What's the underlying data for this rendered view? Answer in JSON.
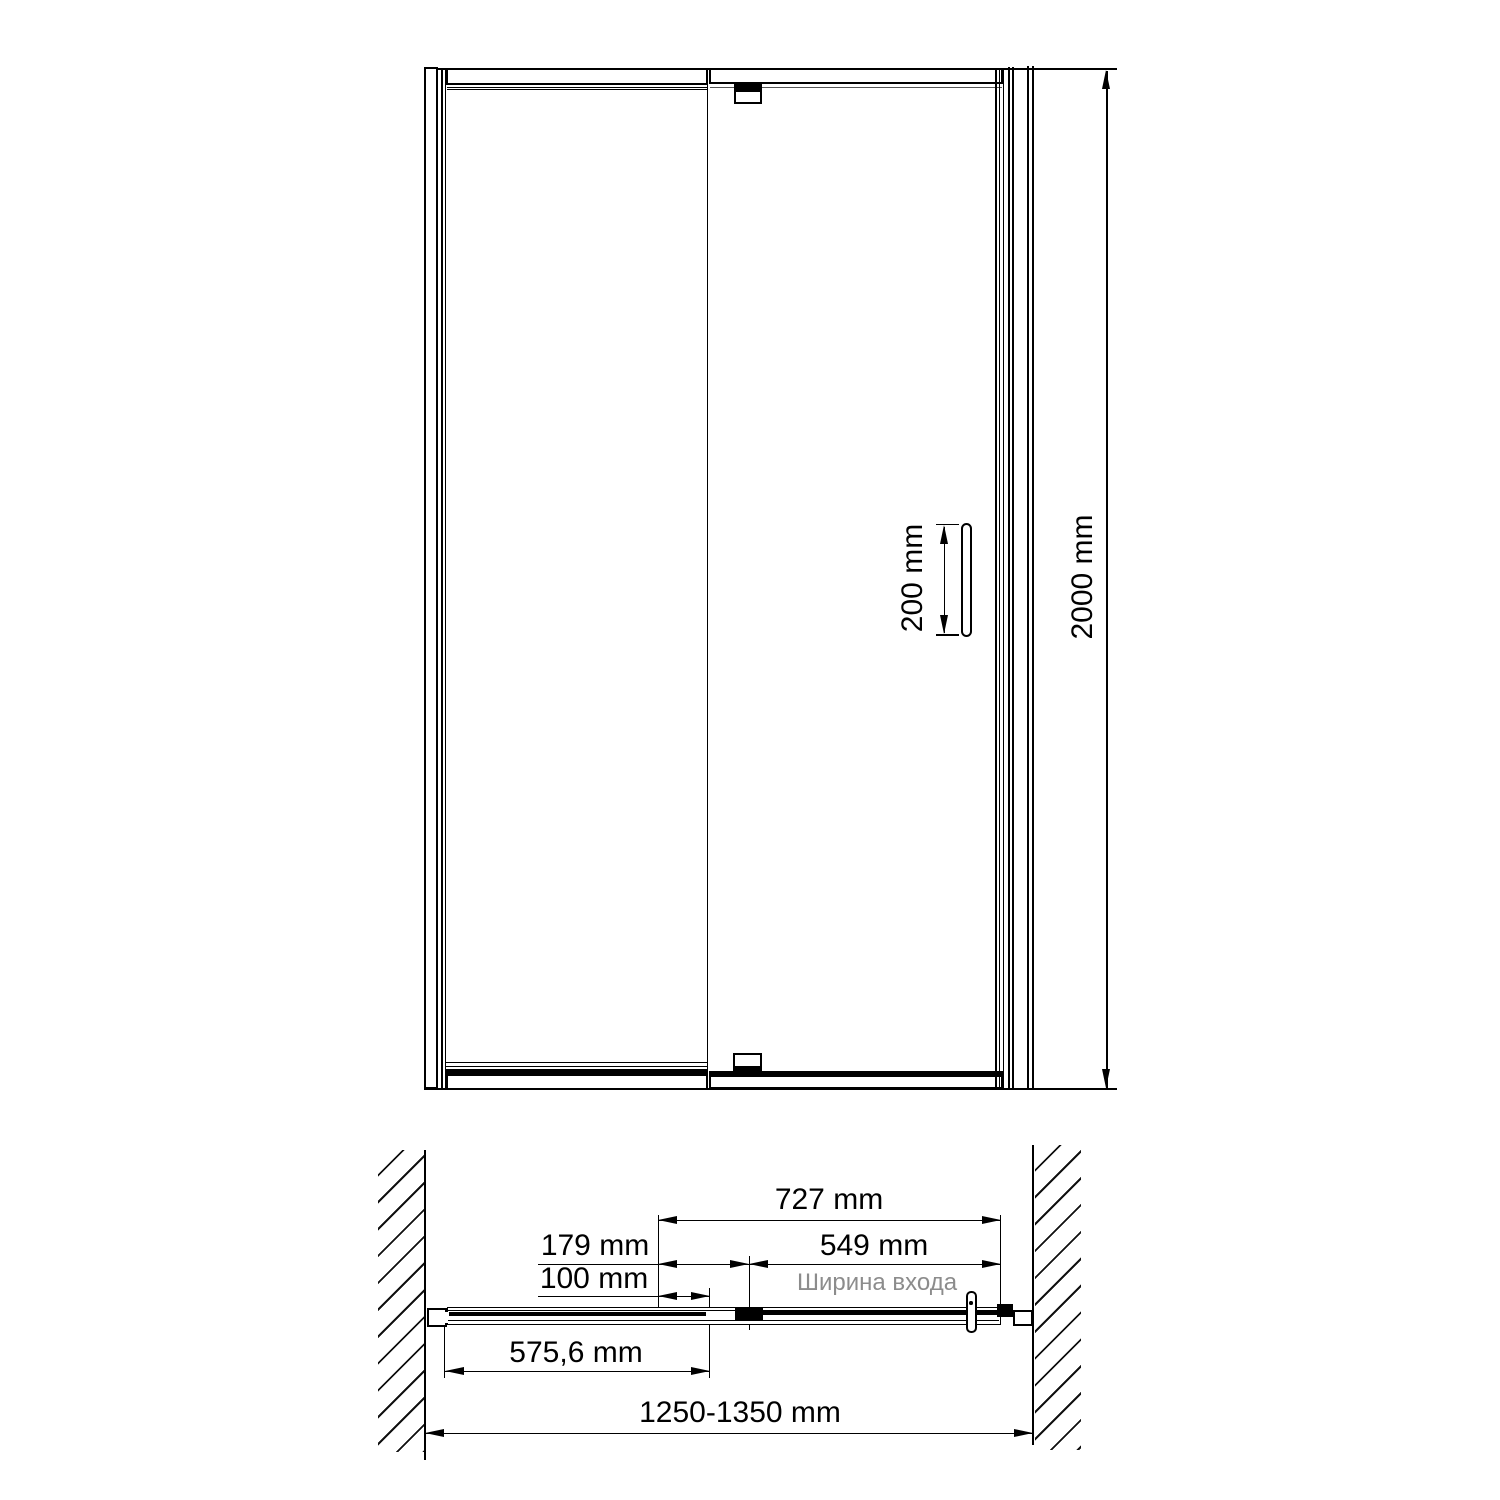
{
  "drawing": {
    "kind": "shower-door installation drawing",
    "views": [
      "front elevation",
      "plan (top) view"
    ]
  },
  "elevation": {
    "total_height_dim": "2000 mm",
    "handle_length_dim": "200 mm"
  },
  "plan": {
    "door_panel_dim": "727 mm",
    "pivot_offset_dim": "179 mm",
    "entry_width_dim": "549 mm",
    "entry_width_caption": "Ширина входа",
    "hinge_gap_dim": "100 mm",
    "fixed_panel_dim": "575,6 mm",
    "overall_width_range_dim": "1250-1350 mm"
  },
  "colors": {
    "line": "#000000",
    "background": "#ffffff",
    "muted_text": "#8c8c8c"
  }
}
